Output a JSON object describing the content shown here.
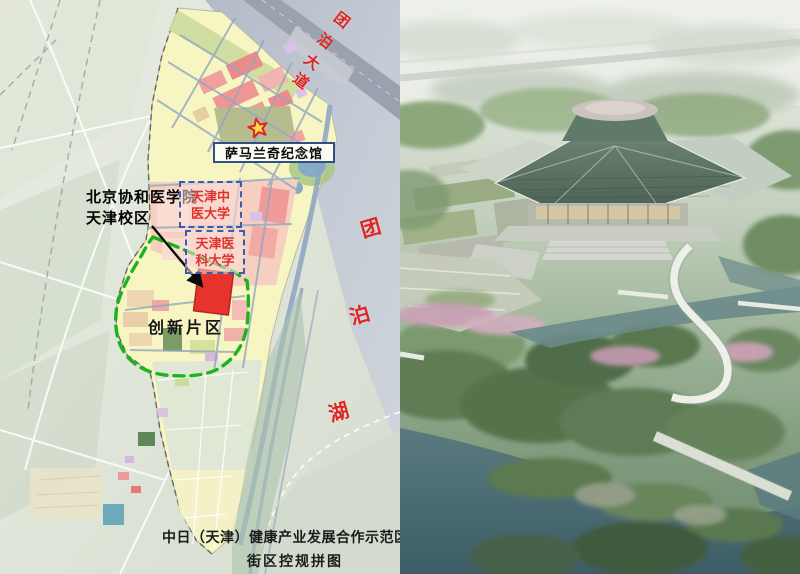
{
  "image": {
    "width": 800,
    "height": 574
  },
  "left_map": {
    "caption": {
      "line1": "中日（天津）健康产业发展合作示范区",
      "line2": "街区控规拼图"
    },
    "labels": {
      "memorial": "萨马兰奇纪念馆",
      "campus_line1": "北京协和医学院",
      "campus_line2": "天津校区",
      "tcm_university": "天津中医大学",
      "medical_university": "天津医科大学",
      "innovation_area": "创新片区",
      "avenue_chars": [
        "团",
        "泊",
        "大",
        "道"
      ],
      "lake_chars": [
        "团",
        "泊",
        "湖"
      ]
    },
    "colors": {
      "red_label": "#e02421",
      "boundary_green": "#1db31d",
      "site_red": "#e6342c",
      "memorial_border": "#2f4f86",
      "dashed_box_border": "#3c5cb0"
    }
  },
  "right_rendering": {
    "colors": {
      "roof_green": "#5c7263",
      "water_teal": "#476570"
    }
  }
}
